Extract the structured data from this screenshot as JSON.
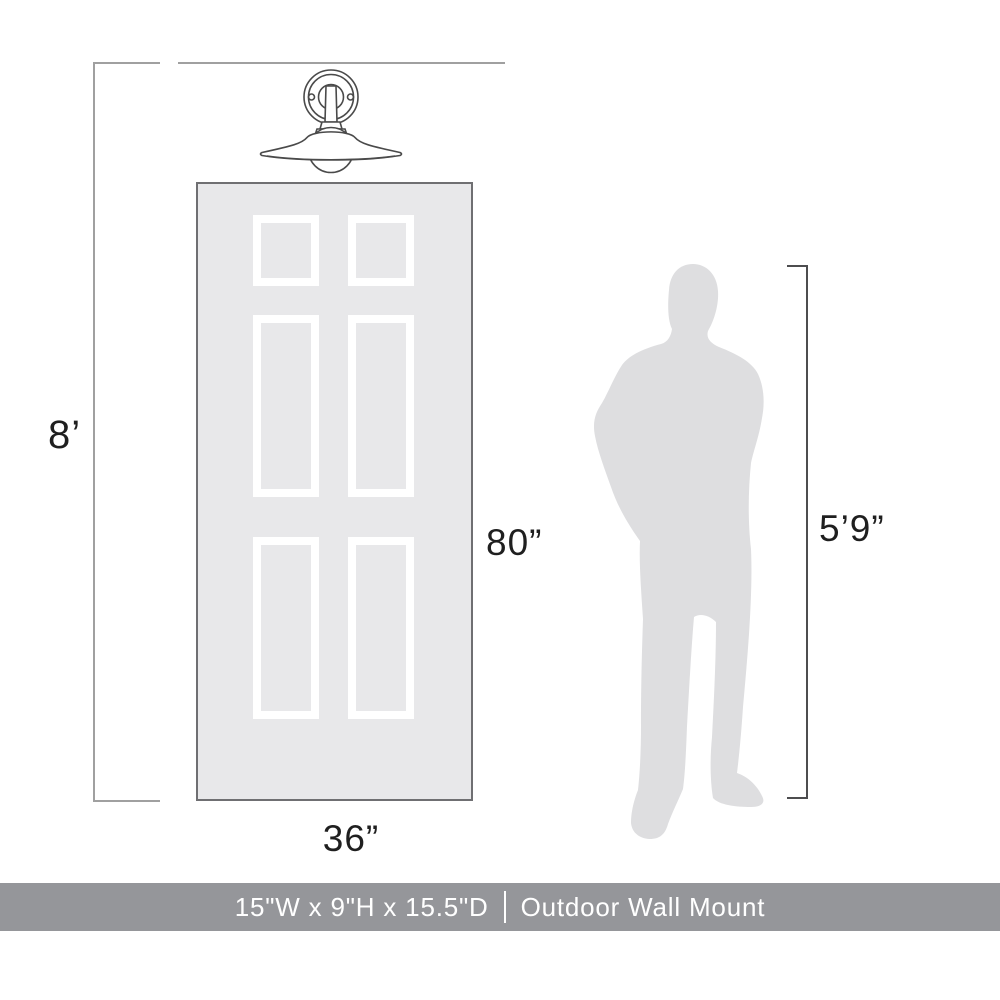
{
  "labels": {
    "ceiling_height": "8’",
    "door_height": "80”",
    "door_width": "36”",
    "person_height": "5’9”"
  },
  "footer": {
    "dimensions": "15\"W x 9\"H x 15.5\"D",
    "separator": "|",
    "mount_type": "Outdoor Wall Mount"
  },
  "icons": {
    "fixture": "wall-sconce-illustration",
    "person": "person-silhouette"
  },
  "colors": {
    "dimension_line_light": "#a0a0a0",
    "dimension_line_dark": "#4d4d4f",
    "door_fill": "#e8e8ea",
    "door_border": "#6f6f72",
    "panel_frame": "#ffffff",
    "silhouette_fill": "#dedee0",
    "fixture_stroke": "#4a4a4a",
    "footer_bar": "#95969a",
    "footer_text": "#ffffff",
    "label_text": "#1f1f1f",
    "background": "#ffffff"
  }
}
